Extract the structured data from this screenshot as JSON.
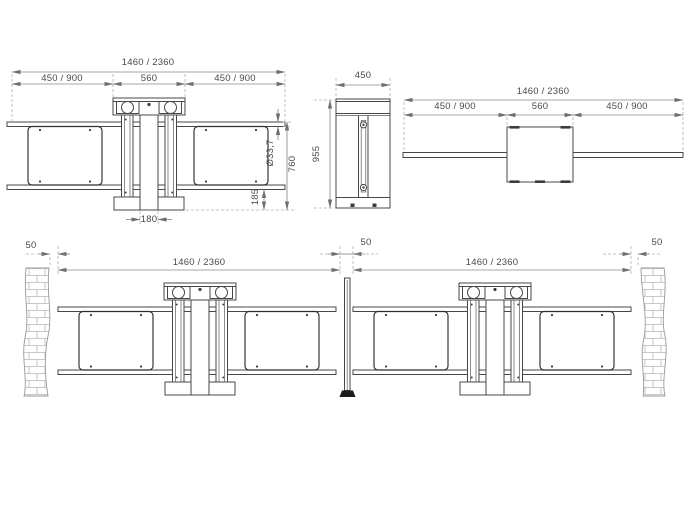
{
  "views": {
    "front": {
      "dims": {
        "overall": "1460 / 2360",
        "left_wing": "450 / 900",
        "head_width": "560",
        "right_wing": "450 / 900",
        "tube_diameter": "Ø33,7",
        "rail_top_height": "760",
        "bottom_rail_height": "185",
        "post_width": "180"
      }
    },
    "side": {
      "dims": {
        "depth": "450",
        "total_height": "955"
      }
    },
    "plan": {
      "dims": {
        "overall": "1460 / 2360",
        "left_wing": "450 / 900",
        "head_width": "560",
        "right_wing": "450 / 900"
      }
    },
    "install_left": {
      "dims": {
        "wall_gap": "50",
        "overall": "1460 / 2360"
      }
    },
    "install_center": {
      "dims": {
        "post_gap": "50"
      }
    },
    "install_right": {
      "dims": {
        "overall": "1460 / 2360",
        "wall_gap": "50"
      }
    }
  },
  "colors": {
    "line": "#474747",
    "dimension": "#8a8a8a",
    "extension": "#b3b3b3",
    "text": "#4a4a4a",
    "background": "#ffffff"
  }
}
